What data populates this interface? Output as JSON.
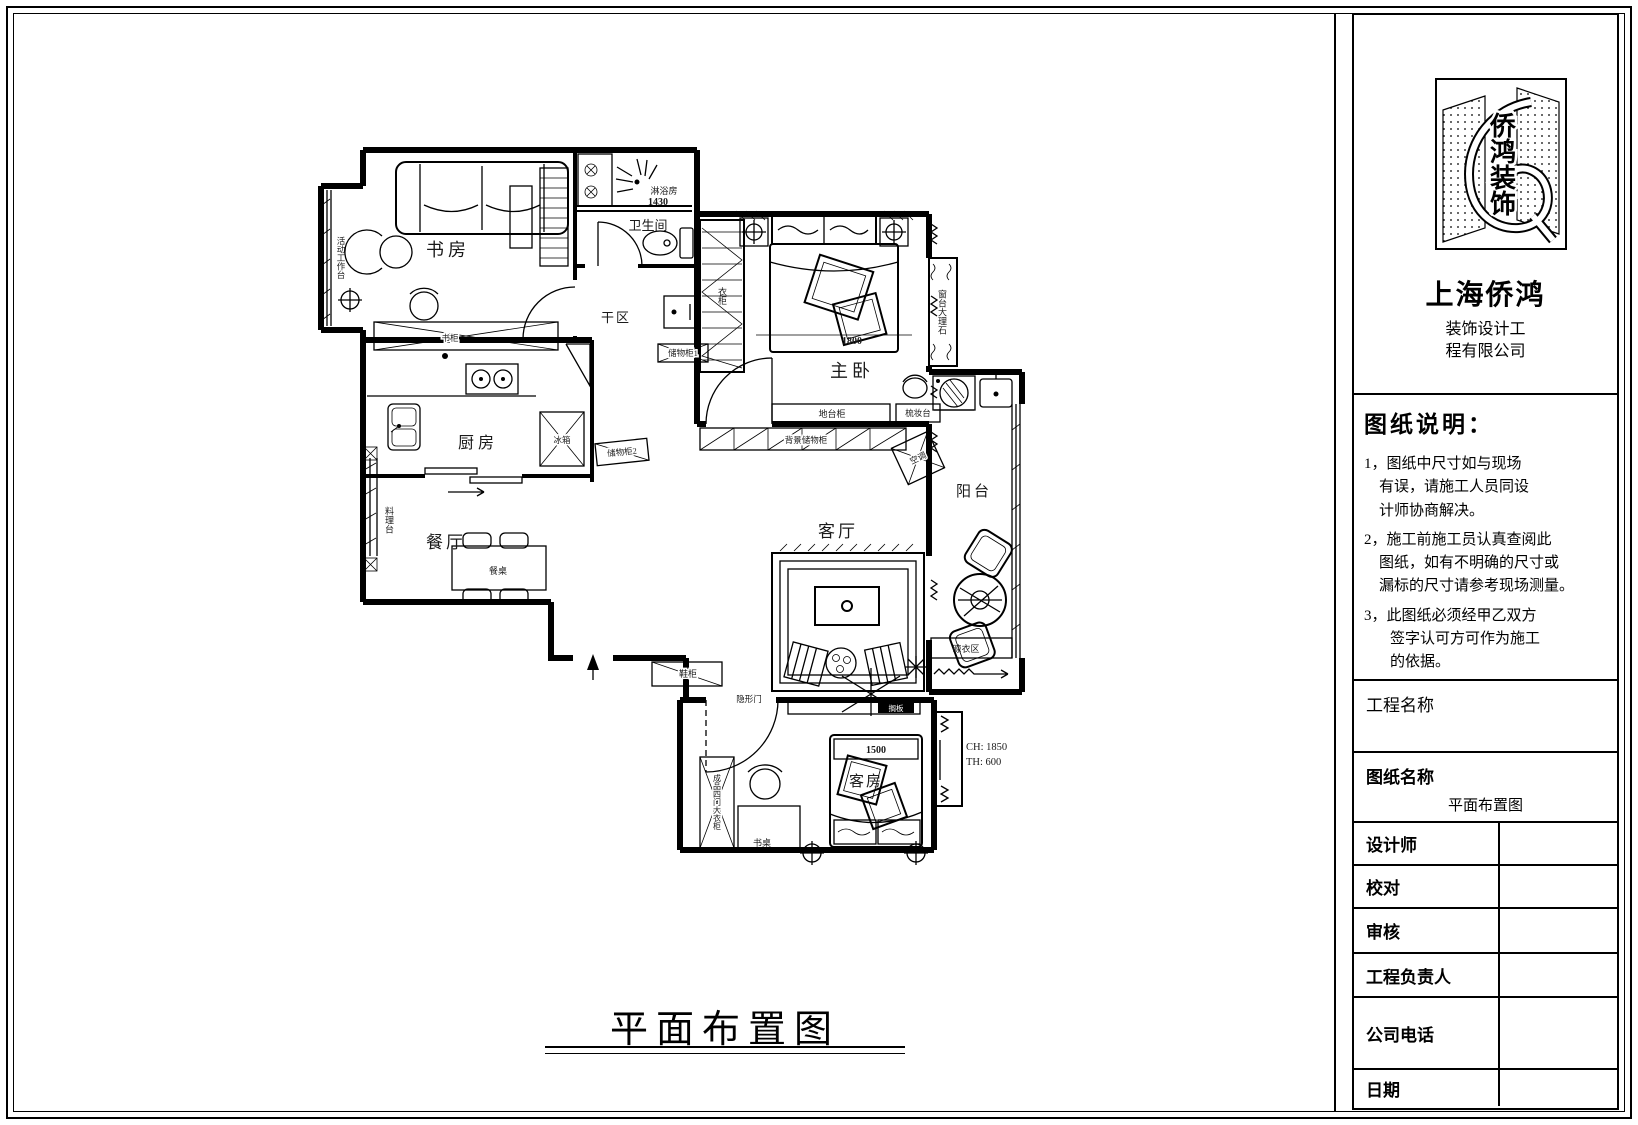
{
  "sheet": {
    "drawing_title": "平面布置图"
  },
  "title_block": {
    "logo_text": "侨鸿装饰",
    "company": {
      "name": "上海侨鸿",
      "line1": "装饰设计工",
      "line2": "程有限公司"
    },
    "notes": {
      "title": "图纸说明：",
      "items": [
        {
          "lines": [
            "1，图纸中尺寸如与现场",
            "有误，请施工人员同设",
            "计师协商解决。"
          ]
        },
        {
          "lines": [
            "2，施工前施工员认真查阅此",
            "图纸，如有不明确的尺寸或",
            "漏标的尺寸请参考现场测量。"
          ]
        },
        {
          "lines": [
            "3，此图纸必须经甲乙双方",
            "签字认可方可作为施工",
            "的依据。"
          ]
        }
      ]
    },
    "project_name_label": "工程名称",
    "sheet_name_label": "图纸名称",
    "sheet_name_value": "平面布置图",
    "fields": [
      {
        "label": "设计师",
        "value": ""
      },
      {
        "label": "校对",
        "value": ""
      },
      {
        "label": "审核",
        "value": ""
      },
      {
        "label": "工程负责人",
        "value": ""
      },
      {
        "label": "公司电话",
        "value": ""
      },
      {
        "label": "日期",
        "value": ""
      }
    ]
  },
  "plan": {
    "rooms": {
      "study": "书房",
      "bathroom": "卫生间",
      "shower_room": "淋浴房",
      "dry_area": "干区",
      "master_bedroom": "主卧",
      "kitchen": "厨房",
      "dining_room": "餐厅",
      "living_room": "客厅",
      "balcony": "阳台",
      "guest_room": "客房",
      "drying_area": "晾衣区"
    },
    "furniture": {
      "work_platform": "活动工作台",
      "bookcase": "书柜",
      "storage_cabinet_1": "储物柜1",
      "storage_cabinet_2": "储物柜2",
      "fridge": "冰箱",
      "prep_counter": "料理台",
      "dining_table": "餐桌",
      "shoe_cabinet": "鞋柜",
      "hidden_door": "隐形门",
      "platform_cabinet": "地台柜",
      "dressing_table": "梳妆台",
      "background_storage": "背景储物柜",
      "air_conditioner": "空调",
      "wardrobe_master": "衣柜",
      "windowsill_marble": "窗台大理石",
      "guest_wardrobe": "成品四门大衣柜",
      "desk": "书桌",
      "shelf": "搁板"
    },
    "dimensions": {
      "shower_width": "1430",
      "master_bed_width": "1800",
      "guest_bed_width": "1500",
      "window_seat_ch": "CH: 1850",
      "window_seat_th": "TH: 600"
    }
  }
}
